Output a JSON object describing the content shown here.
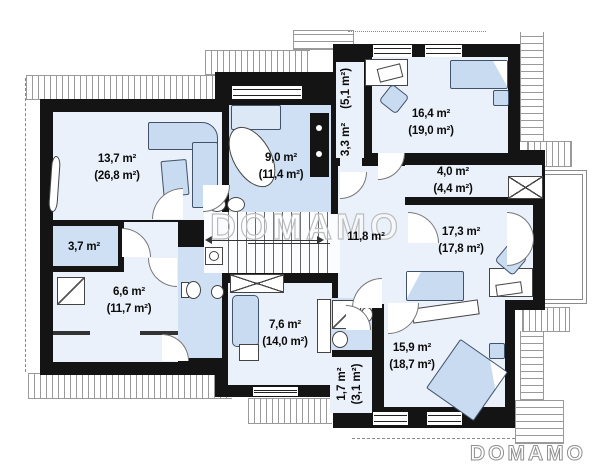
{
  "watermark": "DOMAMO",
  "brand": {
    "logo_text": "DOMAMO"
  },
  "rooms": {
    "living": {
      "area": "13,7 m²",
      "area_total": "(26,8 m²)"
    },
    "bath_main": {
      "area": "9,0 m²",
      "area_total": "(11,4 m²)"
    },
    "wardrobe_corr": {
      "area": "3,3 m²",
      "area_total": "(5,1 m²)"
    },
    "bedroom_top": {
      "area": "16,4 m²",
      "area_total": "(19,0 m²)"
    },
    "niche": {
      "area": "4,0 m²",
      "area_total": "(4,4 m²)"
    },
    "bedroom_right": {
      "area": "17,3 m²",
      "area_total": "(17,8 m²)"
    },
    "hall": {
      "area": "11,8 m²"
    },
    "closet_left": {
      "area": "3,7 m²"
    },
    "bath_left": {
      "area": "6,6 m²",
      "area_total": "(11,7 m²)"
    },
    "lounge": {
      "area": "7,6 m²",
      "area_total": "(14,0 m²)"
    },
    "storage": {
      "area": "1,7 m²",
      "area_total": "(3,1 m²)"
    },
    "bedroom_bottom": {
      "area": "15,9 m²",
      "area_total": "(18,7 m²)"
    }
  }
}
